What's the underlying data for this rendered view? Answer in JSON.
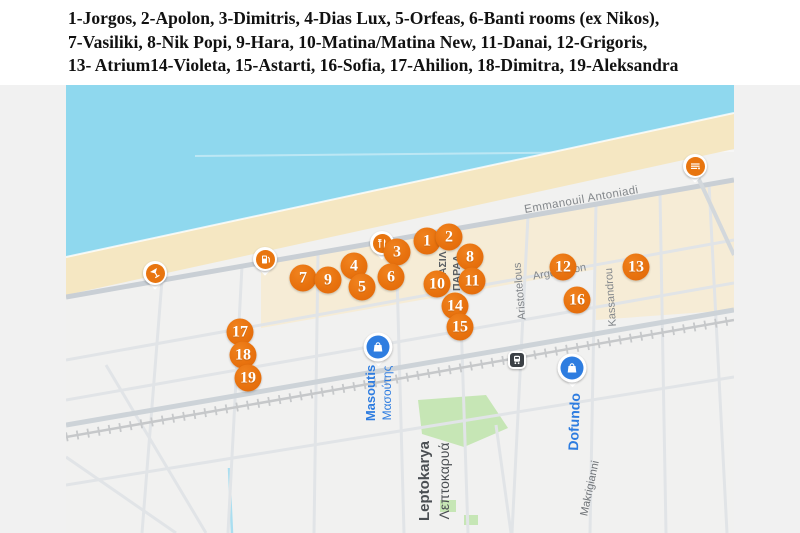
{
  "header": {
    "lines": [
      "1-Jorgos, 2-Apolon, 3-Dimitris, 4-Dias Lux, 5-Orfeas, 6-Banti rooms (ex Nikos),",
      "7-Vasiliki, 8-Nik Popi, 9-Hara, 10-Matina/Matina New, 11-Danai, 12-Grigoris,",
      "13- Atrium14-Violeta, 15-Astarti, 16-Sofia, 17-Ahilion, 18-Dimitra, 19-Aleksandra"
    ]
  },
  "map": {
    "markers": [
      "1",
      "2",
      "3",
      "4",
      "5",
      "6",
      "7",
      "8",
      "9",
      "10",
      "11",
      "12",
      "13",
      "14",
      "15",
      "16",
      "17",
      "18",
      "19"
    ],
    "streets": {
      "emmanouil": "Emmanouil Antoniadi",
      "argonafton": "Argonafton",
      "aristotelous": "Aristotelous",
      "kassandrou": "Kassandrou",
      "makrigianni": "Makrigianni",
      "vasil": "ΒΑΣΙΛ",
      "paral": "ΠΑΡΑΛ"
    },
    "places": {
      "masoutis_en": "Masoutis",
      "masoutis_gr": "Μασούτης",
      "dofundo": "Dofundo",
      "leptokarya_en": "Leptokarya",
      "leptokarya_gr": "Λεπτοκαρυά"
    },
    "icons": {
      "bar": "cocktail-glass",
      "fuel": "fuel-pump",
      "food": "cutlery",
      "restaurant": "fork-knife",
      "masoutis": "shopping-bag",
      "dofundo": "shopping-bag",
      "station": "train"
    },
    "colors": {
      "marker_orange": "#e8720e",
      "poi_orange": "#e8750f",
      "poi_blue": "#2e7de0",
      "sea": "#8fd8ee",
      "beach": "#f5e7c2",
      "beige_blocks": "#f6ecd6",
      "park_green": "#c6e6b5",
      "label_gray": "#83878b",
      "label_dark": "#4b4f53"
    }
  }
}
